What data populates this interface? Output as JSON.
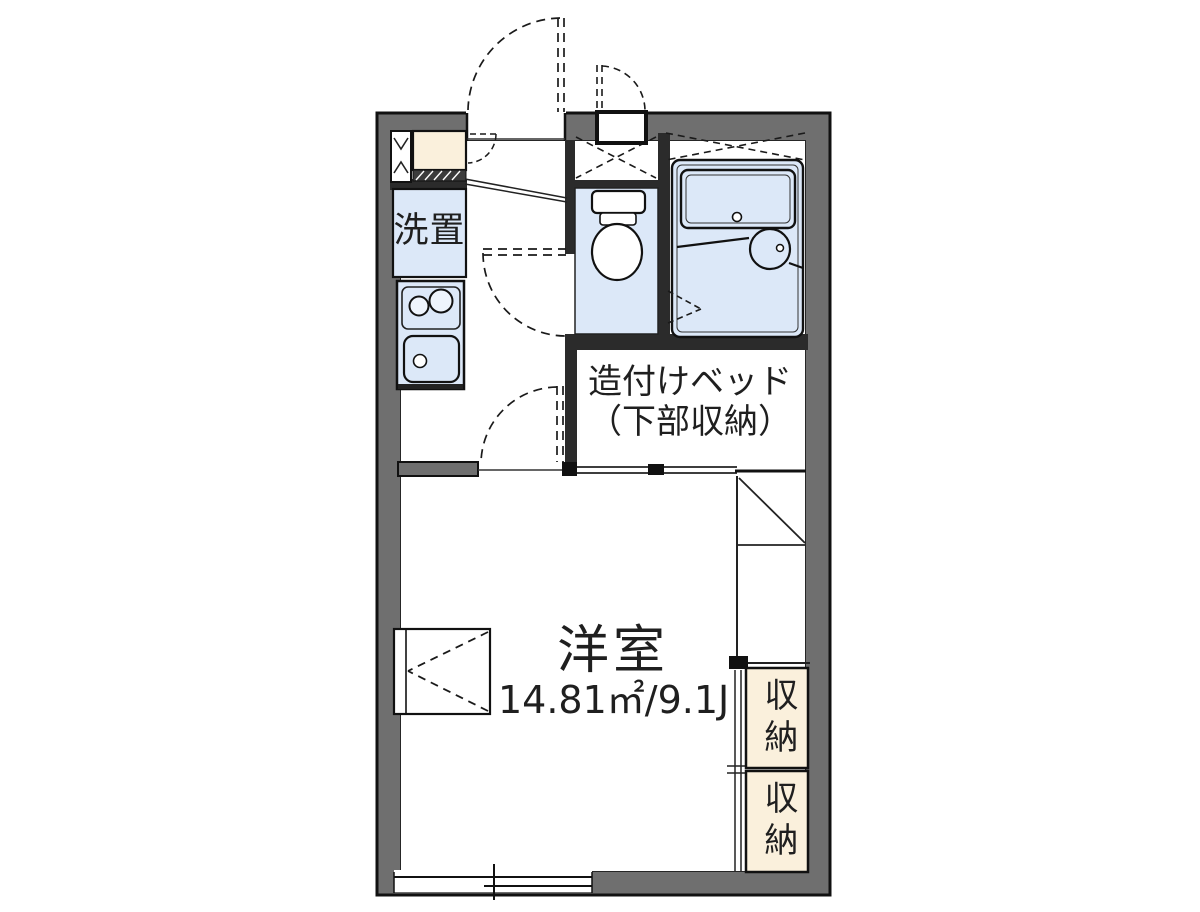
{
  "floor_plan": {
    "rooms": {
      "laundry": {
        "label": "洗置"
      },
      "built_in_bed": {
        "label_line1": "造付けベッド",
        "label_line2": "（下部収納）"
      },
      "western_room": {
        "label": "洋室",
        "area": "14.81㎡/9.1J"
      },
      "closet_upper": {
        "label": "収納"
      },
      "closet_lower": {
        "label": "収納"
      }
    },
    "colors": {
      "wall": "#6f6f6f",
      "wet_area_fill": "#dce8f8",
      "storage_fill": "#faf0dc",
      "line": "#1a1a1a",
      "text": "#1f1f1f",
      "background": "#ffffff"
    }
  }
}
